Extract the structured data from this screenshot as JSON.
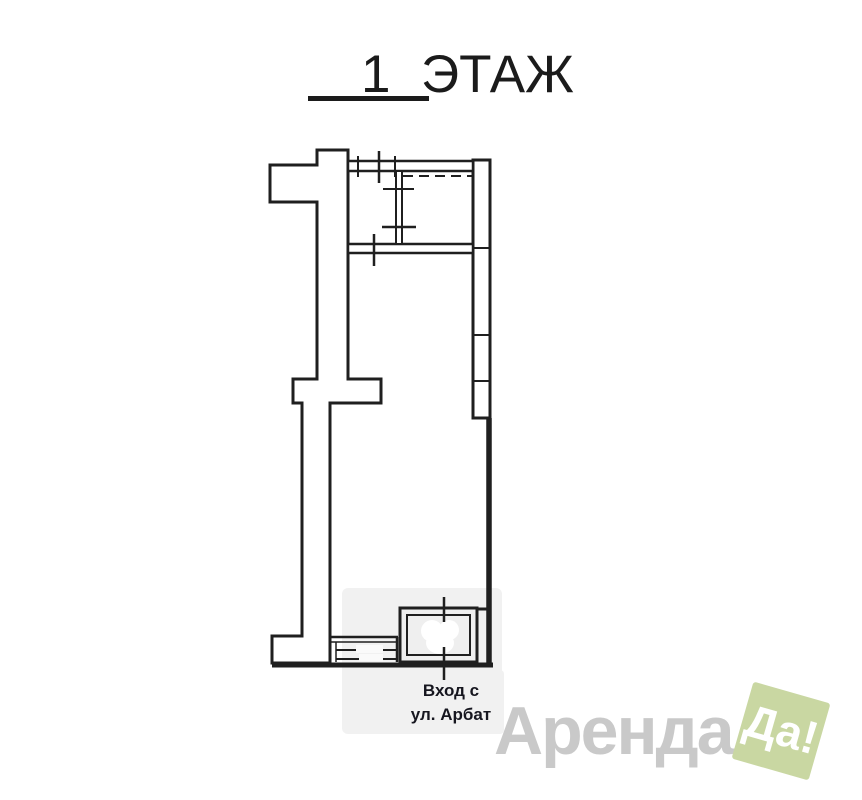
{
  "title": {
    "number": "1",
    "word": "ЭТАЖ"
  },
  "plan": {
    "line_color": "#1f1f1f",
    "smudge_color": "#f1f1f1",
    "entrance": {
      "line1": "Вход с",
      "line2": "ул. Арбат"
    }
  },
  "watermark": {
    "brand_text": "Аренда",
    "badge_text": "Да!",
    "brand_color": "#c9c9c9",
    "badge_bg": "#c9d7a2",
    "badge_text_color": "#ffffff",
    "badge_rotation_deg": 16
  }
}
